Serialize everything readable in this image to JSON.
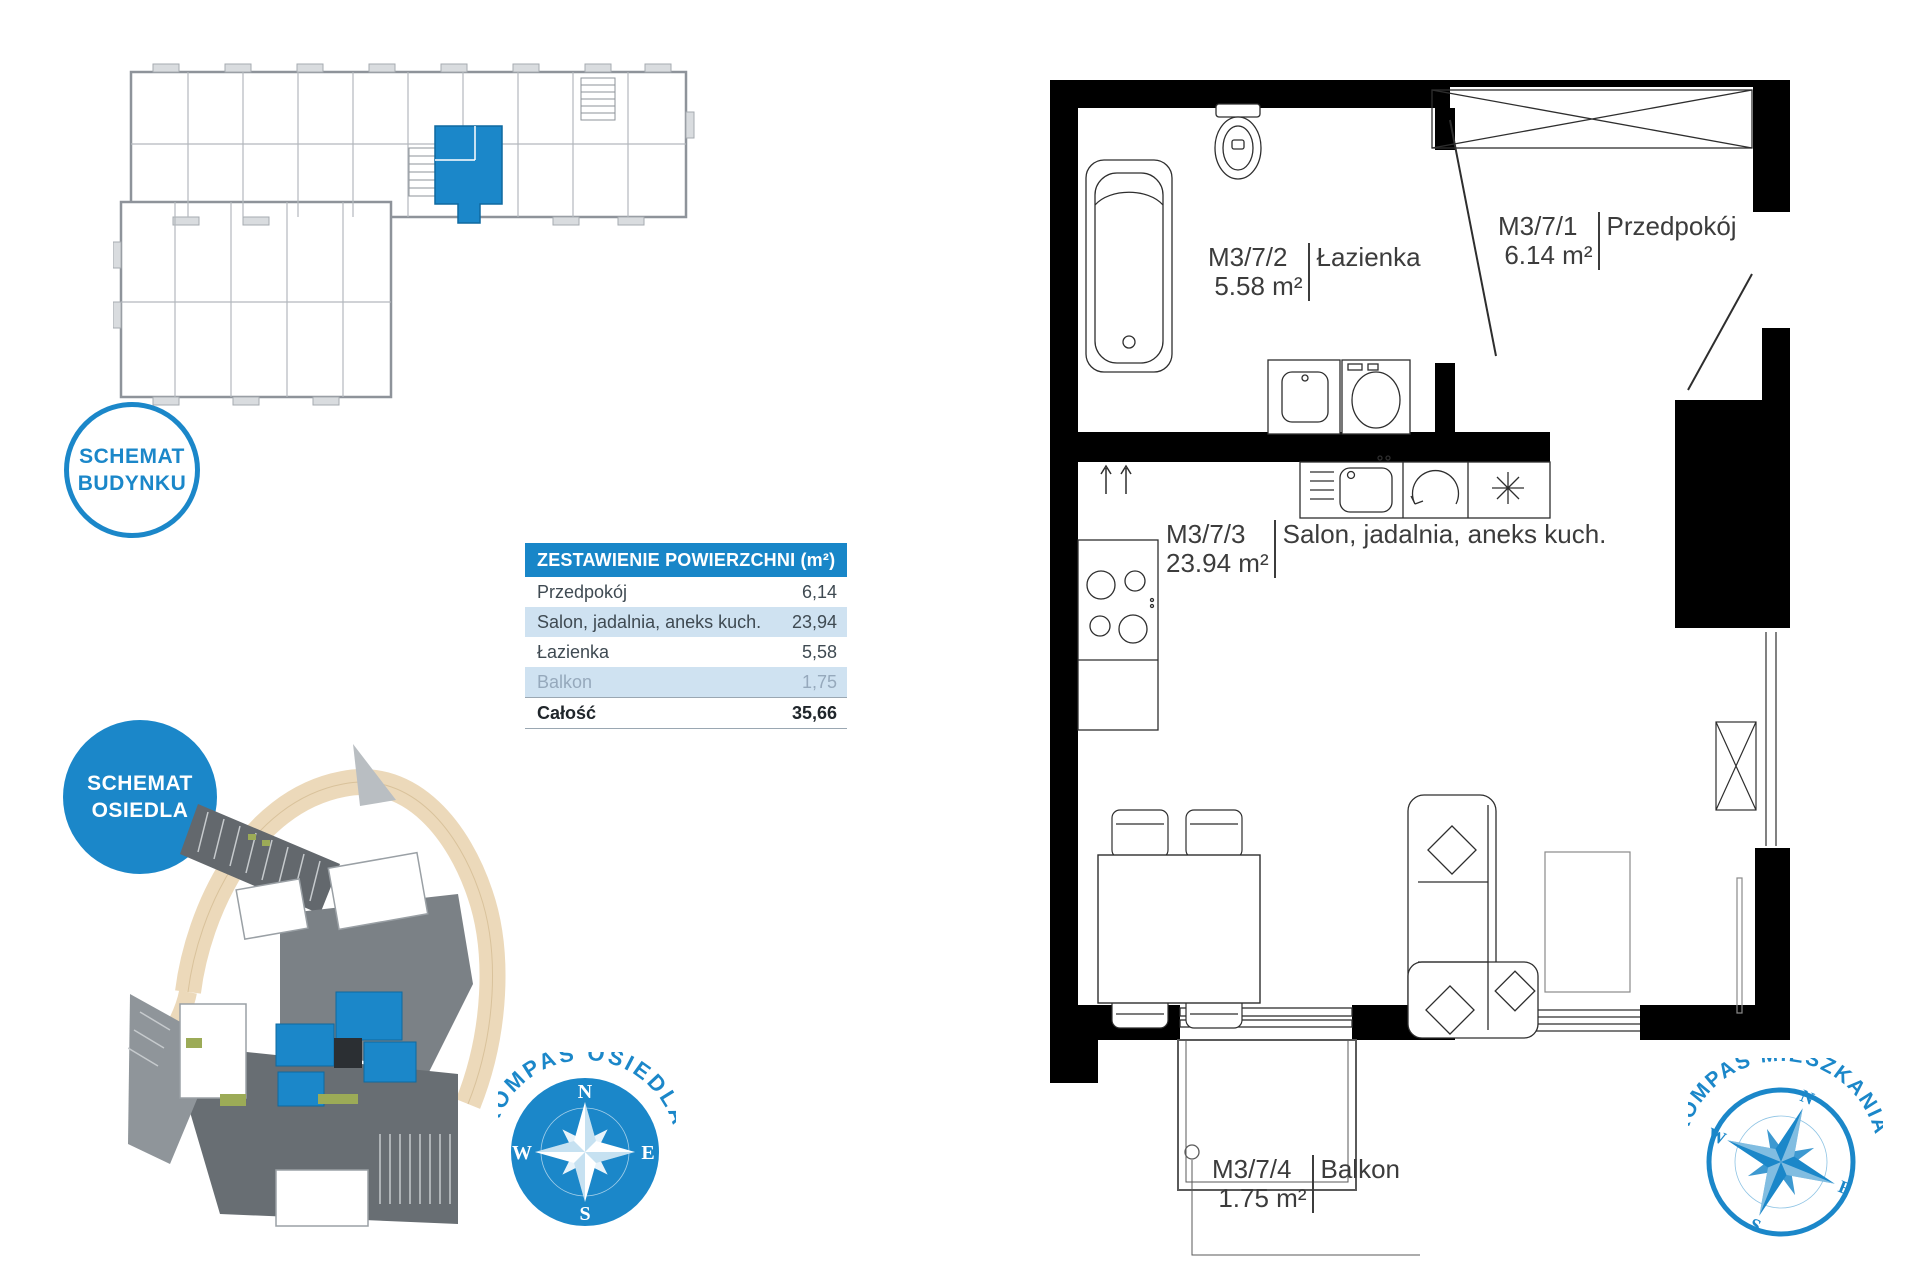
{
  "colors": {
    "accent": "#1b87c9",
    "table_header_bg": "#1886c8",
    "row_alt_bg": "#cfe2f1",
    "muted_text": "#96a9bc",
    "wall_black": "#000000",
    "label_text": "#3c3c3c"
  },
  "badges": {
    "building": {
      "line1": "SCHEMAT",
      "line2": "BUDYNKU"
    },
    "estate": {
      "line1": "SCHEMAT",
      "line2": "OSIEDLA"
    }
  },
  "area_table": {
    "title": "ZESTAWIENIE POWIERZCHNI (m²)",
    "rows": [
      {
        "label": "Przedpokój",
        "value": "6,14"
      },
      {
        "label": "Salon, jadalnia, aneks kuch.",
        "value": "23,94"
      },
      {
        "label": "Łazienka",
        "value": "5,58"
      },
      {
        "label": "Balkon",
        "value": "1,75"
      }
    ],
    "total": {
      "label": "Całość",
      "value": "35,66"
    }
  },
  "floor_plan": {
    "rooms": {
      "bathroom": {
        "id": "M3/7/2",
        "area": "5.58 m²",
        "name": "Łazienka"
      },
      "hall": {
        "id": "M3/7/1",
        "area": "6.14 m²",
        "name": "Przedpokój"
      },
      "living": {
        "id": "M3/7/3",
        "area": "23.94 m²",
        "name": "Salon, jadalnia, aneks kuch."
      },
      "balcony": {
        "id": "M3/7/4",
        "area": "1.75 m²",
        "name": "Balkon"
      }
    }
  },
  "compass_estate": {
    "title": "KOMPAS OSIEDLA",
    "n": "N",
    "e": "E",
    "s": "S",
    "w": "W"
  },
  "compass_apartment": {
    "title": "KOMPAS MIESZKANIA",
    "n": "N",
    "e": "E",
    "s": "S",
    "w": "W"
  }
}
